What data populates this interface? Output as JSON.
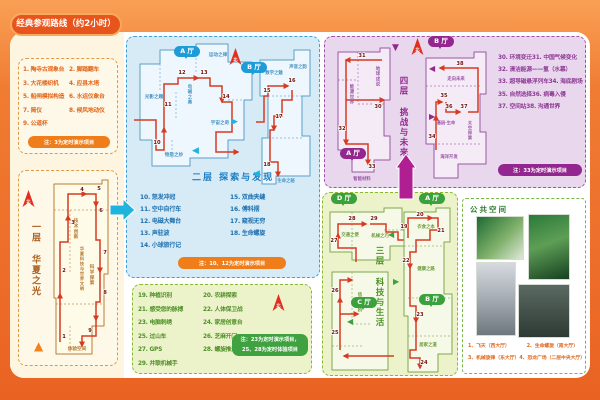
{
  "title": "经典参观路线（约2小时）",
  "compass_label": "北",
  "icons": {
    "chevron_right": "▶",
    "chevron_left": "◀",
    "triangle_up": "▲",
    "triangle_down": "▼"
  },
  "colors": {
    "route": "#d63b22",
    "orange": "#ef7d1a",
    "blue": "#1e9cd7",
    "green": "#3aa13c",
    "purple": "#93278f"
  },
  "floor1": {
    "name": "一层 华夏之光",
    "list": [
      "1. 陶寺古观象台",
      "2. 脚踏翻车",
      "3. 大花楼织机",
      "4. 应县木塔",
      "5. 船闸模拟构造",
      "6. 水运仪象台",
      "7. 简仪",
      "8. 候风地动仪",
      "9. 公道杯"
    ],
    "note": "注：3为定时演示项目",
    "map": {
      "w": 70,
      "h": 184,
      "fill": "#fffbe9",
      "stroke": "#bb7c35",
      "lc": "#b5772f",
      "outline": [
        8,
        8,
        56,
        8,
        56,
        4,
        62,
        4,
        62,
        98,
        58,
        98,
        58,
        150,
        46,
        150,
        46,
        178,
        10,
        178,
        10,
        122,
        8,
        122
      ],
      "inner": [
        [
          8,
          34,
          62,
          34
        ],
        [
          24,
          34,
          24,
          98
        ],
        [
          10,
          128,
          58,
          128
        ],
        [
          24,
          150,
          24,
          178
        ]
      ],
      "routes": [
        [
          14,
          166,
          14,
          118
        ],
        [
          14,
          118,
          14,
          66,
          22,
          66,
          22,
          40
        ],
        [
          22,
          40,
          22,
          18,
          40,
          18
        ],
        [
          40,
          18,
          50,
          18,
          50,
          30
        ],
        [
          50,
          30,
          50,
          64,
          54,
          64,
          54,
          96
        ],
        [
          54,
          96,
          54,
          126,
          50,
          126,
          50,
          144
        ],
        [
          50,
          144,
          50,
          160,
          36,
          160,
          36,
          170
        ]
      ],
      "stops": [
        {
          "n": "1",
          "x": 18,
          "y": 162
        },
        {
          "n": "2",
          "x": 18,
          "y": 96
        },
        {
          "n": "3",
          "x": 27,
          "y": 48
        },
        {
          "n": "4",
          "x": 36,
          "y": 15
        },
        {
          "n": "5",
          "x": 53,
          "y": 14
        },
        {
          "n": "6",
          "x": 55,
          "y": 36
        },
        {
          "n": "7",
          "x": 59,
          "y": 78
        },
        {
          "n": "8",
          "x": 59,
          "y": 118
        },
        {
          "n": "9",
          "x": 44,
          "y": 156
        }
      ],
      "labels": [
        {
          "t": "技术创新",
          "x": 30,
          "y": 46,
          "v": 1,
          "s": 4.6
        },
        {
          "t": "华夏科技与世界文明",
          "x": 36,
          "y": 74,
          "v": 1,
          "s": 4.2
        },
        {
          "t": "科学探索",
          "x": 46,
          "y": 92,
          "v": 1,
          "s": 4.6
        },
        {
          "t": "体验空间",
          "x": 31,
          "y": 174,
          "s": 4.6
        }
      ]
    }
  },
  "floor2": {
    "name": "二层 探索与发现",
    "halls": [
      "A 厅",
      "B 厅"
    ],
    "list": [
      "10. 怒发冲冠",
      "11. 空中自行车",
      "12. 电磁大舞台",
      "13. 声驻波",
      "14. 小球旅行记",
      "15. 双曲夹缝",
      "16. 傅科摆",
      "17. 窥视无穷",
      "18. 生命螺旋"
    ],
    "note": "注：10、12为定时演示项目",
    "mapA": {
      "w": 128,
      "h": 132,
      "fill": "#eef7fd",
      "stroke": "#5b9fc8",
      "lc": "#4a94c4",
      "outline": [
        8,
        24,
        28,
        24,
        28,
        10,
        64,
        10,
        64,
        4,
        96,
        4,
        96,
        22,
        120,
        22,
        120,
        60,
        112,
        60,
        112,
        100,
        96,
        100,
        96,
        118,
        58,
        118,
        58,
        126,
        20,
        126,
        20,
        100,
        8,
        100
      ],
      "inner": [
        [
          28,
          24,
          28,
          52
        ],
        [
          64,
          10,
          64,
          34
        ],
        [
          44,
          52,
          44,
          80
        ],
        [
          96,
          60,
          112,
          60
        ],
        [
          40,
          100,
          40,
          118
        ]
      ],
      "routes": [
        [
          2,
          80,
          24,
          80,
          24,
          110,
          32,
          110,
          32,
          88
        ],
        [
          32,
          88,
          32,
          44,
          46,
          44,
          46,
          38,
          66,
          38
        ],
        [
          66,
          38,
          78,
          38,
          78,
          46,
          90,
          46,
          90,
          62
        ],
        [
          90,
          62,
          100,
          62,
          100,
          92,
          84,
          92,
          84,
          112,
          106,
          112
        ]
      ],
      "stops": [
        {
          "n": "10",
          "x": 25,
          "y": 104
        },
        {
          "n": "11",
          "x": 36,
          "y": 66
        },
        {
          "n": "12",
          "x": 50,
          "y": 34
        },
        {
          "n": "13",
          "x": 72,
          "y": 34
        },
        {
          "n": "14",
          "x": 94,
          "y": 58
        }
      ],
      "labels": [
        {
          "t": "运动之律",
          "x": 86,
          "y": 16,
          "s": 4.6
        },
        {
          "t": "光影之趣",
          "x": 22,
          "y": 58,
          "s": 4.6
        },
        {
          "t": "电磁之奥",
          "x": 58,
          "y": 48,
          "v": 1,
          "s": 4.4
        },
        {
          "t": "宇宙之奇",
          "x": 88,
          "y": 84,
          "s": 4.6
        },
        {
          "t": "物质之妙",
          "x": 42,
          "y": 116,
          "s": 4.6
        }
      ]
    },
    "mapB": {
      "w": 64,
      "h": 146,
      "fill": "#eef7fd",
      "stroke": "#5b9fc8",
      "lc": "#4a94c4",
      "outline": [
        6,
        16,
        40,
        16,
        40,
        6,
        56,
        6,
        56,
        52,
        48,
        52,
        48,
        92,
        56,
        92,
        56,
        132,
        22,
        132,
        22,
        140,
        8,
        140,
        8,
        94,
        14,
        94,
        14,
        52,
        6,
        52
      ],
      "inner": [
        [
          14,
          52,
          48,
          52
        ],
        [
          14,
          94,
          48,
          94
        ]
      ],
      "routes": [
        [
          2,
          78,
          10,
          78,
          10,
          52,
          14,
          52,
          14,
          42,
          34,
          42
        ],
        [
          38,
          46,
          38,
          56,
          28,
          56,
          28,
          72,
          20,
          72,
          20,
          86
        ],
        [
          20,
          86,
          16,
          86,
          16,
          118,
          24,
          118,
          24,
          132
        ]
      ],
      "stops": [
        {
          "n": "15",
          "x": 13,
          "y": 48
        },
        {
          "n": "16",
          "x": 38,
          "y": 38
        },
        {
          "n": "17",
          "x": 25,
          "y": 74
        },
        {
          "n": "18",
          "x": 13,
          "y": 122
        }
      ],
      "labels": [
        {
          "t": "数学之魅",
          "x": 20,
          "y": 30,
          "s": 4.4
        },
        {
          "t": "声音之韵",
          "x": 44,
          "y": 24,
          "s": 4.4
        },
        {
          "t": "生命之秘",
          "x": 32,
          "y": 138,
          "s": 4.4
        }
      ]
    }
  },
  "floor3": {
    "name": "三层 科技与生活",
    "halls": [
      "D 厅",
      "A 厅",
      "B 厅",
      "C 厅"
    ],
    "list": [
      "19. 种植识别",
      "20. 农耕探索",
      "21. 感受您的脉搏",
      "22. 人体保卫战",
      "23. 电脑刺绣",
      "24. 家居创意台",
      "25. 过山车",
      "26. 芝麻开门",
      "27. GPS",
      "28. 螺旋推进器",
      "29. 并联机械手"
    ],
    "note_lines": [
      "注：23为定时演示项目，",
      "25、28为定时体验项目"
    ],
    "mapD": {
      "w": 92,
      "h": 62,
      "fill": "#f6f9e8",
      "stroke": "#7fa851",
      "lc": "#6f9c3f",
      "outline": [
        4,
        8,
        58,
        8,
        58,
        4,
        76,
        4,
        76,
        26,
        88,
        26,
        88,
        42,
        64,
        42,
        64,
        56,
        26,
        56,
        26,
        48,
        4,
        48
      ],
      "inner": [
        [
          26,
          8,
          26,
          48
        ],
        [
          58,
          26,
          76,
          26
        ]
      ],
      "routes": [
        [
          30,
          58,
          30,
          44,
          12,
          44,
          12,
          30
        ],
        [
          12,
          30,
          12,
          20,
          40,
          20
        ],
        [
          44,
          20,
          60,
          20,
          60,
          28,
          72,
          28,
          72,
          36,
          84,
          36
        ]
      ],
      "stops": [
        {
          "n": "27",
          "x": 8,
          "y": 38
        },
        {
          "n": "28",
          "x": 26,
          "y": 16
        },
        {
          "n": "29",
          "x": 48,
          "y": 16
        }
      ],
      "labels": [
        {
          "t": "交通之便",
          "x": 24,
          "y": 32,
          "s": 4.4
        },
        {
          "t": "机械之巧",
          "x": 54,
          "y": 33,
          "s": 4.4
        }
      ]
    },
    "mapC": {
      "w": 72,
      "h": 106,
      "fill": "#f6f9e8",
      "stroke": "#7fa851",
      "lc": "#6f9c3f",
      "outline": [
        8,
        4,
        64,
        4,
        64,
        102,
        8,
        102
      ],
      "inner": [
        [
          28,
          4,
          28,
          56
        ],
        [
          28,
          56,
          48,
          56
        ],
        [
          8,
          78,
          40,
          78
        ]
      ],
      "routes": [
        [
          70,
          88,
          20,
          88
        ],
        [
          16,
          82,
          16,
          30
        ],
        [
          16,
          30,
          16,
          12,
          28,
          12
        ],
        [
          16,
          46,
          34,
          46
        ]
      ],
      "stops": [
        {
          "n": "25",
          "x": 11,
          "y": 66
        },
        {
          "n": "26",
          "x": 11,
          "y": 24
        }
      ],
      "labels": [
        {
          "t": "信息之桥",
          "x": 36,
          "y": 28,
          "v": 1,
          "s": 4.4
        }
      ]
    },
    "mapAB": {
      "w": 64,
      "h": 168,
      "fill": "#f6f9e8",
      "stroke": "#7fa851",
      "lc": "#6f9c3f",
      "outline": [
        10,
        6,
        42,
        6,
        42,
        2,
        56,
        2,
        56,
        36,
        50,
        36,
        50,
        88,
        58,
        88,
        58,
        148,
        44,
        148,
        44,
        166,
        14,
        166,
        14,
        110,
        10,
        110
      ],
      "inner": [
        [
          10,
          40,
          50,
          40
        ],
        [
          14,
          92,
          58,
          92
        ],
        [
          14,
          130,
          58,
          130
        ]
      ],
      "routes": [
        [
          14,
          32,
          14,
          12,
          38,
          12
        ],
        [
          38,
          12,
          44,
          12,
          44,
          24,
          36,
          24,
          36,
          34,
          22,
          34,
          22,
          46,
          16,
          46,
          16,
          62
        ],
        [
          16,
          62,
          16,
          100,
          22,
          100,
          22,
          116
        ],
        [
          22,
          116,
          22,
          144,
          16,
          144,
          16,
          152,
          26,
          152,
          26,
          162
        ]
      ],
      "stops": [
        {
          "n": "19",
          "x": 10,
          "y": 22
        },
        {
          "n": "20",
          "x": 26,
          "y": 10
        },
        {
          "n": "21",
          "x": 47,
          "y": 26
        },
        {
          "n": "22",
          "x": 12,
          "y": 56
        },
        {
          "n": "23",
          "x": 26,
          "y": 110
        },
        {
          "n": "24",
          "x": 30,
          "y": 158
        }
      ],
      "labels": [
        {
          "t": "衣食之本",
          "x": 32,
          "y": 22,
          "s": 4.4
        },
        {
          "t": "健康之路",
          "x": 32,
          "y": 64,
          "s": 4.4
        },
        {
          "t": "居家之道",
          "x": 34,
          "y": 140,
          "s": 4.4
        }
      ]
    }
  },
  "floor4": {
    "name": "四层 挑战与未来",
    "halls": [
      "A 厅",
      "B 厅"
    ],
    "list": [
      "30. 环境变迁",
      "31. 中国气候变化",
      "32. 清洁能源——氢（水幕）",
      "33. 超导磁悬浮列车",
      "34. 海底剧场",
      "35. 自然选择",
      "36. 病毒入侵",
      "37. 空间站",
      "38. 沟通世界"
    ],
    "note": "注：33为定时演示项目",
    "mapA": {
      "w": 64,
      "h": 140,
      "fill": "#f4ebf7",
      "stroke": "#9a57a5",
      "lc": "#9a57a5",
      "outline": [
        6,
        8,
        48,
        8,
        48,
        4,
        58,
        4,
        58,
        56,
        52,
        56,
        52,
        92,
        58,
        92,
        58,
        116,
        42,
        116,
        42,
        128,
        20,
        128,
        20,
        106,
        6,
        106
      ],
      "inner": [
        [
          6,
          36,
          26,
          36
        ],
        [
          26,
          8,
          26,
          60
        ],
        [
          26,
          60,
          52,
          60
        ]
      ],
      "routes": [
        [
          50,
          16,
          14,
          16
        ],
        [
          14,
          16,
          14,
          100
        ],
        [
          14,
          56,
          52,
          56
        ],
        [
          14,
          100,
          36,
          100,
          36,
          120
        ]
      ],
      "stops": [
        {
          "n": "31",
          "x": 30,
          "y": 13
        },
        {
          "n": "30",
          "x": 46,
          "y": 64
        },
        {
          "n": "32",
          "x": 10,
          "y": 86
        },
        {
          "n": "33",
          "x": 40,
          "y": 124
        }
      ],
      "labels": [
        {
          "t": "能源世界",
          "x": 20,
          "y": 44,
          "v": 1,
          "s": 4.4
        },
        {
          "t": "地球述说",
          "x": 46,
          "y": 26,
          "v": 1,
          "s": 4.4
        },
        {
          "t": "智能材料",
          "x": 30,
          "y": 136,
          "s": 4.4
        }
      ]
    },
    "mapB": {
      "w": 76,
      "h": 140,
      "fill": "#f4ebf7",
      "stroke": "#9a57a5",
      "lc": "#9a57a5",
      "outline": [
        10,
        12,
        58,
        12,
        58,
        6,
        70,
        6,
        70,
        48,
        64,
        48,
        64,
        86,
        70,
        86,
        70,
        118,
        42,
        118,
        42,
        132,
        18,
        132,
        18,
        98,
        10,
        98
      ],
      "inner": [
        [
          10,
          40,
          64,
          40
        ],
        [
          18,
          98,
          64,
          98
        ]
      ],
      "routes": [
        [
          20,
          104,
          20,
          70
        ],
        [
          20,
          70,
          20,
          56,
          26,
          56
        ],
        [
          30,
          56,
          30,
          66,
          44,
          66
        ],
        [
          52,
          66,
          62,
          66,
          62,
          22,
          24,
          22
        ]
      ],
      "stops": [
        {
          "n": "34",
          "x": 16,
          "y": 92
        },
        {
          "n": "35",
          "x": 28,
          "y": 51
        },
        {
          "n": "36",
          "x": 33,
          "y": 62
        },
        {
          "n": "37",
          "x": 48,
          "y": 62
        },
        {
          "n": "38",
          "x": 44,
          "y": 19
        }
      ],
      "labels": [
        {
          "t": "走向未来",
          "x": 40,
          "y": 34,
          "s": 4.4
        },
        {
          "t": "基因·生命",
          "x": 30,
          "y": 78,
          "s": 4.2
        },
        {
          "t": "太空探索",
          "x": 54,
          "y": 78,
          "v": 1,
          "s": 4.2
        },
        {
          "t": "海洋开发",
          "x": 33,
          "y": 112,
          "s": 4.4
        }
      ]
    }
  },
  "public_space": {
    "title": "公共空间",
    "captions": [
      "1、飞天（西大厅）",
      "2、生命螺旋（南大厅）",
      "3、机械旋律（东大厅）",
      "4、恐龙广场（二层中央大厅）"
    ]
  }
}
